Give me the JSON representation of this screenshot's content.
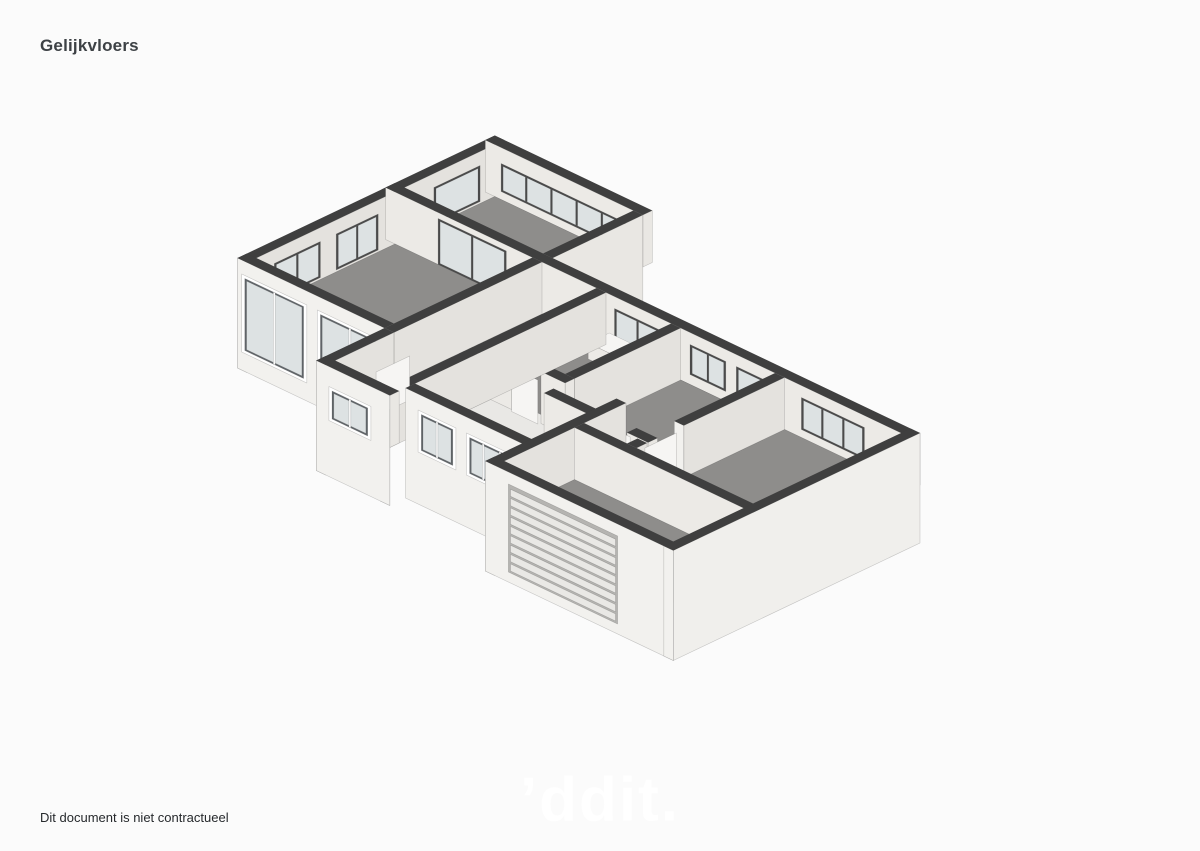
{
  "page": {
    "title": "Gelijkvloers",
    "footer": "Dit document is niet contractueel",
    "watermark": "’ddit.",
    "background": "#fbfbfb",
    "palette": {
      "wall_top": "#3f3f3f",
      "wall_light": "#f2f1ee",
      "wall_shade": "#e9e7e3",
      "wall_int_v": "#eceae6",
      "wall_int_u": "#e4e2de",
      "facade_right": "#f0efec",
      "floor_gray": "#8e8d8b",
      "floor_light": "#e9e8e5",
      "glass": "#dde2e3",
      "frame_dark": "#4b4b4b",
      "frame_light": "#ffffff",
      "stair_tread": "#fafaf8",
      "stair_riser": "#d6d5d2",
      "garage_door_slat": "#e9e8e5",
      "garage_door_base": "#b5b4b1",
      "furniture_white": "#f6f5f3"
    }
  }
}
